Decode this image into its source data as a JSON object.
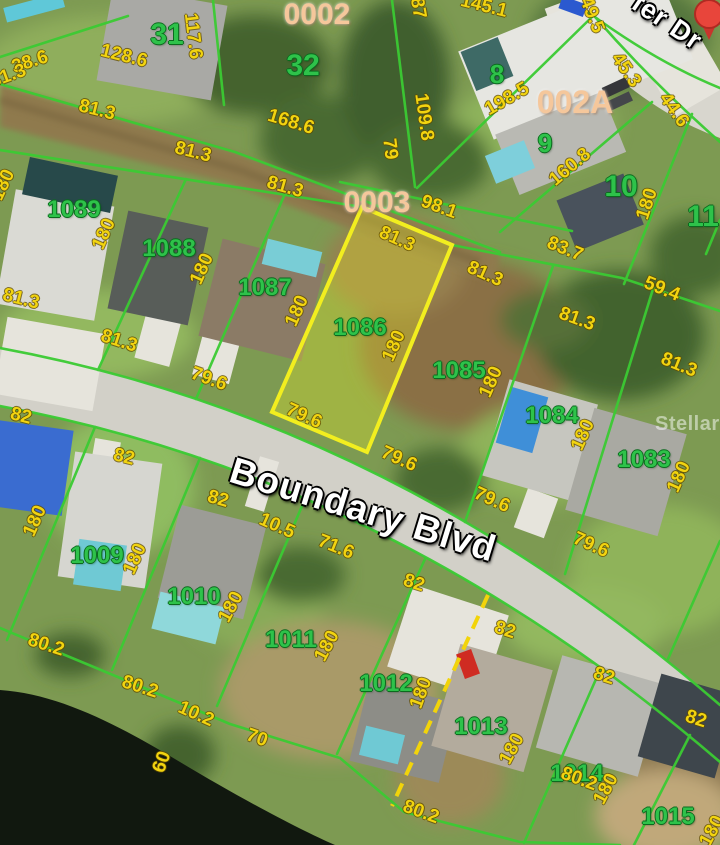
{
  "map": {
    "watermark": "StellarMLS",
    "streets": [
      {
        "name": "Boundary Blvd"
      },
      {
        "name": "fer Dr"
      }
    ],
    "highlighted_lot": "1086",
    "colors": {
      "parcel_highlight_stroke": "#f2ee1f",
      "parcel_highlight_fill": "rgba(230,230,40,0.33)",
      "lot_line_green": "#3bcb33",
      "lot_number_green": "#2ec24a",
      "dimension_yellow": "#f2d410",
      "block_label_peach": "#f5c79b",
      "pin_red": "#e8453b"
    },
    "labels": [
      {
        "type": "lot",
        "text": "31",
        "x": 167,
        "y": 35,
        "size": 30
      },
      {
        "type": "lot",
        "text": "32",
        "x": 303,
        "y": 66,
        "size": 30
      },
      {
        "type": "lot",
        "text": "8",
        "x": 497,
        "y": 74,
        "size": 26
      },
      {
        "type": "lot",
        "text": "9",
        "x": 545,
        "y": 143,
        "size": 26
      },
      {
        "type": "lot",
        "text": "10",
        "x": 621,
        "y": 187,
        "size": 30
      },
      {
        "type": "lot",
        "text": "11",
        "x": 703,
        "y": 217,
        "size": 30
      },
      {
        "type": "lot",
        "text": "1089",
        "x": 74,
        "y": 210,
        "size": 24
      },
      {
        "type": "lot",
        "text": "1088",
        "x": 169,
        "y": 249,
        "size": 24
      },
      {
        "type": "lot",
        "text": "1087",
        "x": 265,
        "y": 288,
        "size": 24
      },
      {
        "type": "lot",
        "text": "1086",
        "x": 360,
        "y": 328,
        "size": 24
      },
      {
        "type": "lot",
        "text": "1085",
        "x": 459,
        "y": 371,
        "size": 24
      },
      {
        "type": "lot",
        "text": "1084",
        "x": 552,
        "y": 416,
        "size": 24
      },
      {
        "type": "lot",
        "text": "1083",
        "x": 644,
        "y": 460,
        "size": 24
      },
      {
        "type": "lot",
        "text": "1009",
        "x": 97,
        "y": 556,
        "size": 24
      },
      {
        "type": "lot",
        "text": "1010",
        "x": 194,
        "y": 597,
        "size": 24
      },
      {
        "type": "lot",
        "text": "1011",
        "x": 291,
        "y": 640,
        "size": 24
      },
      {
        "type": "lot",
        "text": "1012",
        "x": 386,
        "y": 684,
        "size": 24
      },
      {
        "type": "lot",
        "text": "1013",
        "x": 481,
        "y": 727,
        "size": 24
      },
      {
        "type": "lot",
        "text": "1014",
        "x": 577,
        "y": 774,
        "size": 24
      },
      {
        "type": "lot",
        "text": "1015",
        "x": 668,
        "y": 817,
        "size": 24
      },
      {
        "type": "block",
        "text": "0002",
        "x": 317,
        "y": 15,
        "size": 30
      },
      {
        "type": "block",
        "text": "002A",
        "x": 575,
        "y": 102,
        "size": 32
      },
      {
        "type": "block",
        "text": "0003",
        "x": 377,
        "y": 203,
        "size": 30
      },
      {
        "type": "dim",
        "text": "38.6",
        "x": 30,
        "y": 62,
        "rot": -18
      },
      {
        "type": "dim",
        "text": "128.6",
        "x": 124,
        "y": 56,
        "rot": 14
      },
      {
        "type": "dim",
        "text": "117.6",
        "x": 193,
        "y": 36,
        "rot": 83
      },
      {
        "type": "dim",
        "text": "168.6",
        "x": 291,
        "y": 122,
        "rot": 17
      },
      {
        "type": "dim",
        "text": "79",
        "x": 390,
        "y": 149,
        "rot": 83
      },
      {
        "type": "dim",
        "text": "87",
        "x": 418,
        "y": 8,
        "rot": 80
      },
      {
        "type": "dim",
        "text": "145.1",
        "x": 484,
        "y": 6,
        "rot": 14
      },
      {
        "type": "dim",
        "text": "49.5",
        "x": 592,
        "y": 15,
        "rot": 68
      },
      {
        "type": "dim",
        "text": "109.8",
        "x": 424,
        "y": 117,
        "rot": 82
      },
      {
        "type": "dim",
        "text": "198.5",
        "x": 507,
        "y": 99,
        "rot": -30
      },
      {
        "type": "dim",
        "text": "45.3",
        "x": 626,
        "y": 70,
        "rot": 55
      },
      {
        "type": "dim",
        "text": "44.6",
        "x": 674,
        "y": 110,
        "rot": 55
      },
      {
        "type": "dim",
        "text": "160.8",
        "x": 570,
        "y": 167,
        "rot": -40
      },
      {
        "type": "dim",
        "text": "98.1",
        "x": 439,
        "y": 207,
        "rot": 20
      },
      {
        "type": "dim",
        "text": "83.7",
        "x": 565,
        "y": 249,
        "rot": 22
      },
      {
        "type": "dim",
        "text": "59.4",
        "x": 662,
        "y": 289,
        "rot": 22
      },
      {
        "type": "dim",
        "text": "81.3",
        "x": 8,
        "y": 76,
        "rot": -20
      },
      {
        "type": "dim",
        "text": "81.3",
        "x": 97,
        "y": 110,
        "rot": 14
      },
      {
        "type": "dim",
        "text": "81.3",
        "x": 193,
        "y": 152,
        "rot": 14
      },
      {
        "type": "dim",
        "text": "81.3",
        "x": 285,
        "y": 187,
        "rot": 16
      },
      {
        "type": "dim",
        "text": "81.3",
        "x": 397,
        "y": 239,
        "rot": 24
      },
      {
        "type": "dim",
        "text": "81.3",
        "x": 485,
        "y": 274,
        "rot": 24
      },
      {
        "type": "dim",
        "text": "81.3",
        "x": 577,
        "y": 319,
        "rot": 20
      },
      {
        "type": "dim",
        "text": "81.3",
        "x": 679,
        "y": 365,
        "rot": 22
      },
      {
        "type": "dim",
        "text": "81.3",
        "x": 119,
        "y": 341,
        "rot": 18
      },
      {
        "type": "dim",
        "text": "81.3",
        "x": 21,
        "y": 299,
        "rot": 14
      },
      {
        "type": "dim",
        "text": "180",
        "x": 3,
        "y": 185,
        "rot": -65
      },
      {
        "type": "dim",
        "text": "180",
        "x": 104,
        "y": 234,
        "rot": -66
      },
      {
        "type": "dim",
        "text": "180",
        "x": 202,
        "y": 269,
        "rot": -66
      },
      {
        "type": "dim",
        "text": "180",
        "x": 297,
        "y": 311,
        "rot": -66
      },
      {
        "type": "dim",
        "text": "180",
        "x": 394,
        "y": 346,
        "rot": -66
      },
      {
        "type": "dim",
        "text": "180",
        "x": 491,
        "y": 382,
        "rot": -66
      },
      {
        "type": "dim",
        "text": "180",
        "x": 583,
        "y": 435,
        "rot": -66
      },
      {
        "type": "dim",
        "text": "180",
        "x": 679,
        "y": 477,
        "rot": -66
      },
      {
        "type": "dim",
        "text": "180",
        "x": 647,
        "y": 204,
        "rot": -72
      },
      {
        "type": "dim",
        "text": "79.6",
        "x": 209,
        "y": 379,
        "rot": 20
      },
      {
        "type": "dim",
        "text": "79.6",
        "x": 304,
        "y": 416,
        "rot": 24
      },
      {
        "type": "dim",
        "text": "79.6",
        "x": 399,
        "y": 459,
        "rot": 24
      },
      {
        "type": "dim",
        "text": "79.6",
        "x": 492,
        "y": 500,
        "rot": 24
      },
      {
        "type": "dim",
        "text": "79.6",
        "x": 591,
        "y": 545,
        "rot": 24
      },
      {
        "type": "dim",
        "text": "82",
        "x": 21,
        "y": 416,
        "rot": 14
      },
      {
        "type": "dim",
        "text": "82",
        "x": 124,
        "y": 457,
        "rot": 14
      },
      {
        "type": "dim",
        "text": "82",
        "x": 218,
        "y": 499,
        "rot": 16
      },
      {
        "type": "dim",
        "text": "10.5",
        "x": 277,
        "y": 526,
        "rot": 24
      },
      {
        "type": "dim",
        "text": "71.6",
        "x": 336,
        "y": 547,
        "rot": 22
      },
      {
        "type": "dim",
        "text": "82",
        "x": 414,
        "y": 583,
        "rot": 18
      },
      {
        "type": "dim",
        "text": "82",
        "x": 505,
        "y": 630,
        "rot": 18
      },
      {
        "type": "dim",
        "text": "82",
        "x": 604,
        "y": 676,
        "rot": 18
      },
      {
        "type": "dim",
        "text": "82",
        "x": 696,
        "y": 719,
        "rot": 18
      },
      {
        "type": "dim",
        "text": "180",
        "x": 35,
        "y": 521,
        "rot": -66
      },
      {
        "type": "dim",
        "text": "180",
        "x": 135,
        "y": 559,
        "rot": -66
      },
      {
        "type": "dim",
        "text": "180",
        "x": 231,
        "y": 607,
        "rot": -62
      },
      {
        "type": "dim",
        "text": "180",
        "x": 327,
        "y": 646,
        "rot": -62
      },
      {
        "type": "dim",
        "text": "180",
        "x": 421,
        "y": 693,
        "rot": -70
      },
      {
        "type": "dim",
        "text": "180",
        "x": 512,
        "y": 749,
        "rot": -62
      },
      {
        "type": "dim",
        "text": "180",
        "x": 606,
        "y": 789,
        "rot": -62
      },
      {
        "type": "dim",
        "text": "180",
        "x": 712,
        "y": 831,
        "rot": -62
      },
      {
        "type": "dim",
        "text": "80.2",
        "x": 46,
        "y": 645,
        "rot": 18
      },
      {
        "type": "dim",
        "text": "80.2",
        "x": 140,
        "y": 687,
        "rot": 18
      },
      {
        "type": "dim",
        "text": "10.2",
        "x": 196,
        "y": 714,
        "rot": 24
      },
      {
        "type": "dim",
        "text": "70",
        "x": 257,
        "y": 738,
        "rot": 20
      },
      {
        "type": "dim",
        "text": "60",
        "x": 162,
        "y": 762,
        "rot": -70
      },
      {
        "type": "dim",
        "text": "80.2",
        "x": 421,
        "y": 812,
        "rot": 20
      },
      {
        "type": "dim",
        "text": "80.2",
        "x": 579,
        "y": 779,
        "rot": 20
      }
    ]
  }
}
